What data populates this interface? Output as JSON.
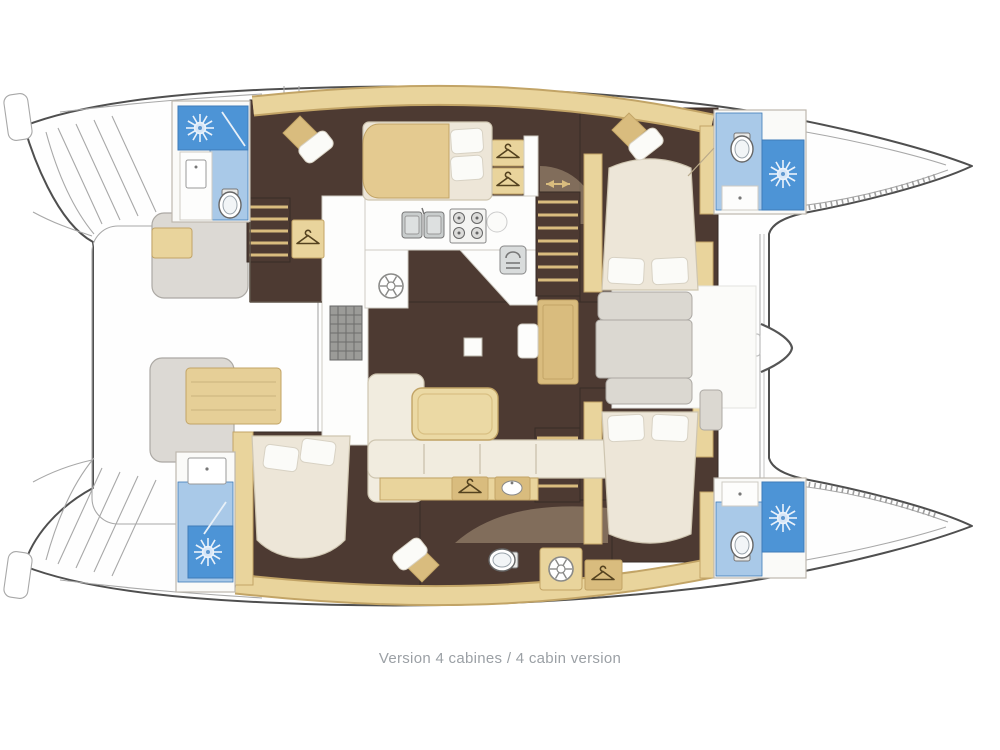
{
  "caption": "Version 4 cabines / 4 cabin version",
  "palette": {
    "outline": "#4F4F4F",
    "line_light": "#A8A8A8",
    "floor_brown": "#4D3A32",
    "floor_edge": "#382C26",
    "wood_tan": "#E9D49C",
    "wood_tan_deep": "#D9BC7E",
    "wood_tan_edge": "#C2A466",
    "table_tan": "#EBD9A4",
    "blanket_tan": "#E4CA90",
    "cream": "#F1ECDF",
    "cream_edge": "#CEC5B0",
    "bed_cream": "#EDE6D8",
    "pillow": "#FBFBF8",
    "pillow_edge": "#D8D2C4",
    "bench_gray": "#DCD9D4",
    "bench_edge": "#ACA9A4",
    "panel_gray": "#DBD8D1",
    "mat_tan": "#E6CF97",
    "bath_white": "#FAFAF8",
    "counter_white": "#FDFDFC",
    "light_blue": "#A9C9E8",
    "dark_blue": "#4D94D6",
    "blue_edge": "#3E7BB8",
    "steel": "#C9CDCD",
    "steel_edge": "#777777",
    "caption_gray": "#9BA0A5"
  },
  "icons": {
    "shower": "sunburst shower head",
    "toilet": "toilet bowl with tank",
    "hanger": "wardrobe clothes hanger",
    "washbasin": "sink basin",
    "galley_sink": "double square sink",
    "stove": "four burner stove",
    "spoke_wheel": "round spoked hatch",
    "stairs": "companionway steps",
    "arrows": "two-way passage arrows"
  }
}
